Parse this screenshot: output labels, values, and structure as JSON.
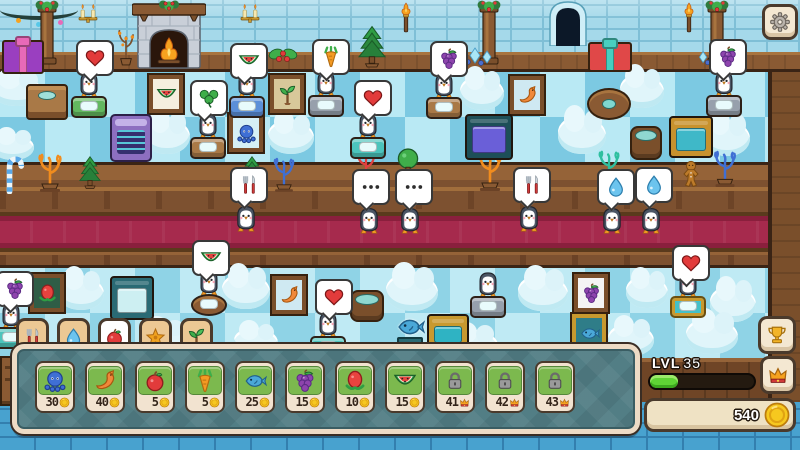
{
  "colors": {
    "carpet": "#a62a4d",
    "panel": "#527e85",
    "xp": "#5fd435",
    "coin_gold": "#f6c81f",
    "wall_blue": "#a5d9ea"
  },
  "hud": {
    "settings_icon": "gear",
    "trophy_icon": "trophy",
    "crown_icon": "crown",
    "tabs": [
      {
        "icon": "cutlery",
        "selected": false
      },
      {
        "icon": "drop",
        "selected": false
      },
      {
        "icon": "apple",
        "selected": true
      },
      {
        "icon": "flower",
        "selected": false
      },
      {
        "icon": "sapling",
        "selected": false
      }
    ],
    "shop_items": [
      {
        "icon": "octopus",
        "price": "30",
        "currency": "coin",
        "locked": false
      },
      {
        "icon": "shrimp",
        "price": "40",
        "currency": "coin",
        "locked": false
      },
      {
        "icon": "apple",
        "price": "5",
        "currency": "coin",
        "locked": false
      },
      {
        "icon": "carrot",
        "price": "5",
        "currency": "coin",
        "locked": false
      },
      {
        "icon": "fish",
        "price": "25",
        "currency": "coin",
        "locked": false
      },
      {
        "icon": "grapes",
        "price": "15",
        "currency": "coin",
        "locked": false
      },
      {
        "icon": "dragonfruit",
        "price": "10",
        "currency": "coin",
        "locked": false
      },
      {
        "icon": "watermelon",
        "price": "15",
        "currency": "coin",
        "locked": false
      },
      {
        "icon": "lock",
        "price": "41",
        "currency": "crown",
        "locked": true
      },
      {
        "icon": "lock",
        "price": "42",
        "currency": "crown",
        "locked": true
      },
      {
        "icon": "lock",
        "price": "43",
        "currency": "crown",
        "locked": true
      }
    ],
    "level": {
      "label": "LVL",
      "value": "35",
      "progress_pct": 27
    },
    "coins": {
      "value": "540"
    }
  },
  "scene": {
    "elements": [
      {
        "t": "garland",
        "x": 0,
        "y": 0,
        "w": 78,
        "h": 16
      },
      {
        "t": "pillar",
        "x": 30,
        "y": 0,
        "w": 34,
        "h": 70
      },
      {
        "t": "sconce",
        "x": 76,
        "y": 3,
        "w": 24,
        "h": 20
      },
      {
        "t": "fireplace",
        "x": 132,
        "y": 0,
        "w": 74,
        "h": 70
      },
      {
        "t": "plant",
        "x": 114,
        "y": 28,
        "w": 24,
        "h": 38
      },
      {
        "t": "sconce",
        "x": 238,
        "y": 3,
        "w": 24,
        "h": 20
      },
      {
        "t": "holly",
        "x": 266,
        "y": 44,
        "w": 34,
        "h": 26
      },
      {
        "t": "pine",
        "x": 358,
        "y": 24,
        "w": 28,
        "h": 44
      },
      {
        "t": "torch",
        "x": 398,
        "y": 2,
        "w": 16,
        "h": 32
      },
      {
        "t": "pillar",
        "x": 472,
        "y": 0,
        "w": 34,
        "h": 70
      },
      {
        "t": "crystals",
        "x": 452,
        "y": 46,
        "w": 46,
        "h": 22
      },
      {
        "t": "door",
        "x": 546,
        "y": 0,
        "w": 44,
        "h": 46
      },
      {
        "t": "gift",
        "v": "red",
        "x": 588,
        "y": 42,
        "w": 40,
        "h": 26
      },
      {
        "t": "torch",
        "x": 681,
        "y": 2,
        "w": 16,
        "h": 32
      },
      {
        "t": "pillar",
        "x": 700,
        "y": 0,
        "w": 34,
        "h": 70
      },
      {
        "t": "crystals",
        "x": 694,
        "y": 48,
        "w": 40,
        "h": 20
      },
      {
        "t": "gift",
        "v": "purple",
        "x": 2,
        "y": 40,
        "w": 38,
        "h": 30
      },
      {
        "t": "cloud",
        "x": -8,
        "y": 76,
        "w": 50,
        "h": 30
      },
      {
        "t": "sideboard",
        "x": 26,
        "y": 84,
        "w": 38,
        "h": 32
      },
      {
        "t": "bubble",
        "v": "heart",
        "x": 76,
        "y": 40,
        "i": 1
      },
      {
        "t": "diner",
        "v": "green",
        "x": 71,
        "y": 72,
        "i": 1
      },
      {
        "t": "frame",
        "v": "watermelon",
        "x": 149,
        "y": 75,
        "i": 1
      },
      {
        "t": "cloud",
        "x": -8,
        "y": 134,
        "w": 42,
        "h": 26
      },
      {
        "t": "cloud",
        "x": 144,
        "y": 118,
        "w": 46,
        "h": 36
      },
      {
        "t": "bubble",
        "v": "watermelon",
        "x": 230,
        "y": 43,
        "i": 1
      },
      {
        "t": "diner",
        "v": "blue",
        "x": 229,
        "y": 72,
        "i": 1
      },
      {
        "t": "frame",
        "v": "plant",
        "x": 270,
        "y": 75,
        "i": 1
      },
      {
        "t": "bubble",
        "v": "carrot",
        "x": 312,
        "y": 39,
        "i": 1
      },
      {
        "t": "diner",
        "v": "gray",
        "x": 308,
        "y": 71,
        "i": 1
      },
      {
        "t": "bubble",
        "v": "heart",
        "x": 354,
        "y": 80,
        "i": 1
      },
      {
        "t": "diner",
        "v": "teal",
        "x": 350,
        "y": 113,
        "i": 1
      },
      {
        "t": "bubble",
        "v": "grapes",
        "x": 430,
        "y": 41,
        "i": 1
      },
      {
        "t": "diner",
        "v": "wood",
        "x": 426,
        "y": 73,
        "i": 1
      },
      {
        "t": "cloud",
        "x": 460,
        "y": 76,
        "w": 44,
        "h": 34
      },
      {
        "t": "frame",
        "v": "shrimp",
        "x": 510,
        "y": 76,
        "i": 1
      },
      {
        "t": "roundtable",
        "x": 587,
        "y": 88,
        "w": 40,
        "h": 28
      },
      {
        "t": "cloud",
        "x": 620,
        "y": 74,
        "w": 44,
        "h": 34
      },
      {
        "t": "bubble",
        "v": "grapes",
        "x": 709,
        "y": 39,
        "i": 1
      },
      {
        "t": "diner",
        "v": "gray",
        "x": 706,
        "y": 71,
        "i": 1
      },
      {
        "t": "arcade",
        "x": 110,
        "y": 114,
        "w": 38,
        "h": 44
      },
      {
        "t": "bubble",
        "v": "clover",
        "x": 190,
        "y": 80,
        "i": 1
      },
      {
        "t": "diner",
        "v": "wood",
        "x": 190,
        "y": 113,
        "i": 1
      },
      {
        "t": "frame",
        "v": "octopus",
        "x": 229,
        "y": 114,
        "i": 1
      },
      {
        "t": "cloud",
        "x": 268,
        "y": 120,
        "w": 46,
        "h": 34
      },
      {
        "t": "oven",
        "v": "dark",
        "x": 465,
        "y": 114,
        "w": 44,
        "h": 42
      },
      {
        "t": "cloud",
        "x": 558,
        "y": 116,
        "w": 48,
        "h": 38
      },
      {
        "t": "barrel",
        "x": 630,
        "y": 126,
        "w": 28,
        "h": 30
      },
      {
        "t": "oven",
        "v": "gold",
        "x": 669,
        "y": 116,
        "w": 40,
        "h": 38
      },
      {
        "t": "cloud",
        "x": 704,
        "y": 120,
        "w": 46,
        "h": 36
      },
      {
        "t": "candy",
        "x": 2,
        "y": 156,
        "w": 24,
        "h": 38
      },
      {
        "t": "coral",
        "v": "orange",
        "x": 32,
        "y": 152,
        "w": 36,
        "h": 42
      },
      {
        "t": "pine",
        "x": 79,
        "y": 152,
        "w": 22,
        "h": 40
      },
      {
        "t": "pine",
        "x": 241,
        "y": 152,
        "w": 22,
        "h": 40
      },
      {
        "t": "coral",
        "v": "blue",
        "x": 268,
        "y": 156,
        "w": 32,
        "h": 38
      },
      {
        "t": "coral",
        "v": "red",
        "x": 348,
        "y": 150,
        "w": 36,
        "h": 34
      },
      {
        "t": "treeball",
        "x": 395,
        "y": 148,
        "w": 26,
        "h": 32
      },
      {
        "t": "coral",
        "v": "orange",
        "x": 470,
        "y": 152,
        "w": 40,
        "h": 40
      },
      {
        "t": "coral",
        "v": "teal",
        "x": 590,
        "y": 150,
        "w": 38,
        "h": 36
      },
      {
        "t": "ginger",
        "x": 681,
        "y": 160,
        "w": 20,
        "h": 28
      },
      {
        "t": "coral",
        "v": "blue",
        "x": 708,
        "y": 150,
        "w": 34,
        "h": 38
      },
      {
        "t": "bubble",
        "v": "cutlery",
        "x": 230,
        "y": 167,
        "i": 1
      },
      {
        "t": "pg",
        "x": 234,
        "y": 203,
        "i": 1
      },
      {
        "t": "bubble",
        "v": "dots",
        "x": 352,
        "y": 169,
        "i": 1
      },
      {
        "t": "pg",
        "x": 357,
        "y": 205,
        "i": 1
      },
      {
        "t": "bubble",
        "v": "dots",
        "x": 395,
        "y": 169,
        "i": 1
      },
      {
        "t": "pg",
        "x": 398,
        "y": 205,
        "i": 1
      },
      {
        "t": "bubble",
        "v": "cutlery",
        "x": 513,
        "y": 167,
        "i": 1
      },
      {
        "t": "pg",
        "x": 517,
        "y": 203,
        "i": 1
      },
      {
        "t": "bubble",
        "v": "drop",
        "x": 597,
        "y": 169,
        "i": 1
      },
      {
        "t": "pg",
        "x": 600,
        "y": 205,
        "i": 1
      },
      {
        "t": "bubble",
        "v": "drop",
        "x": 635,
        "y": 167,
        "i": 1
      },
      {
        "t": "pg",
        "x": 639,
        "y": 205,
        "i": 1
      },
      {
        "t": "bubble",
        "v": "grapes",
        "x": -4,
        "y": 271,
        "i": 1
      },
      {
        "t": "diner",
        "v": "teal",
        "x": -7,
        "y": 303,
        "i": 1
      },
      {
        "t": "frame",
        "v": "redfruit",
        "x": 30,
        "y": 274,
        "i": 1
      },
      {
        "t": "cloud",
        "x": 58,
        "y": 276,
        "w": 46,
        "h": 34
      },
      {
        "t": "oven",
        "v": "teal",
        "x": 110,
        "y": 276,
        "w": 40,
        "h": 40
      },
      {
        "t": "bubble",
        "v": "watermelon",
        "x": 192,
        "y": 240,
        "i": 1
      },
      {
        "t": "diner",
        "v": "round",
        "x": 191,
        "y": 270,
        "i": 1
      },
      {
        "t": "cloud",
        "x": 222,
        "y": 273,
        "w": 48,
        "h": 36
      },
      {
        "t": "frame",
        "v": "shrimp",
        "x": 272,
        "y": 276,
        "i": 1
      },
      {
        "t": "bubble",
        "v": "heart",
        "x": 315,
        "y": 279,
        "i": 1
      },
      {
        "t": "diner",
        "v": "teal",
        "x": 310,
        "y": 312,
        "i": 1
      },
      {
        "t": "barrel",
        "x": 350,
        "y": 290,
        "w": 30,
        "h": 28
      },
      {
        "t": "cloud",
        "x": 386,
        "y": 273,
        "w": 52,
        "h": 38
      },
      {
        "t": "diner",
        "v": "gray",
        "x": 470,
        "y": 272,
        "i": 1
      },
      {
        "t": "cloud",
        "x": 518,
        "y": 275,
        "w": 50,
        "h": 36
      },
      {
        "t": "frame",
        "v": "grapes",
        "x": 574,
        "y": 274,
        "i": 1
      },
      {
        "t": "cloud",
        "x": 626,
        "y": 276,
        "w": 42,
        "h": 32
      },
      {
        "t": "bubble",
        "v": "heart",
        "x": 672,
        "y": 245,
        "i": 1
      },
      {
        "t": "diner",
        "v": "gold",
        "x": 670,
        "y": 272,
        "i": 1
      },
      {
        "t": "cloud",
        "x": 710,
        "y": 286,
        "w": 46,
        "h": 36
      },
      {
        "t": "fishstatue",
        "x": 392,
        "y": 312,
        "w": 36,
        "h": 36
      },
      {
        "t": "oven",
        "v": "gold2",
        "x": 427,
        "y": 314,
        "w": 38,
        "h": 32
      },
      {
        "t": "cloud",
        "x": 450,
        "y": 330,
        "w": 48,
        "h": 30
      },
      {
        "t": "frame",
        "v": "fish",
        "x": 572,
        "y": 314,
        "i": 1
      },
      {
        "t": "cloud",
        "x": 608,
        "y": 324,
        "w": 46,
        "h": 32
      },
      {
        "t": "cloud",
        "x": 686,
        "y": 318,
        "w": 52,
        "h": 36
      },
      {
        "t": "cloud",
        "x": 140,
        "y": 324,
        "w": 48,
        "h": 28
      },
      {
        "t": "cloud",
        "x": 234,
        "y": 328,
        "w": 44,
        "h": 28
      },
      {
        "t": "dresser",
        "x": 0,
        "y": 356,
        "w": 20,
        "h": 46
      }
    ]
  }
}
